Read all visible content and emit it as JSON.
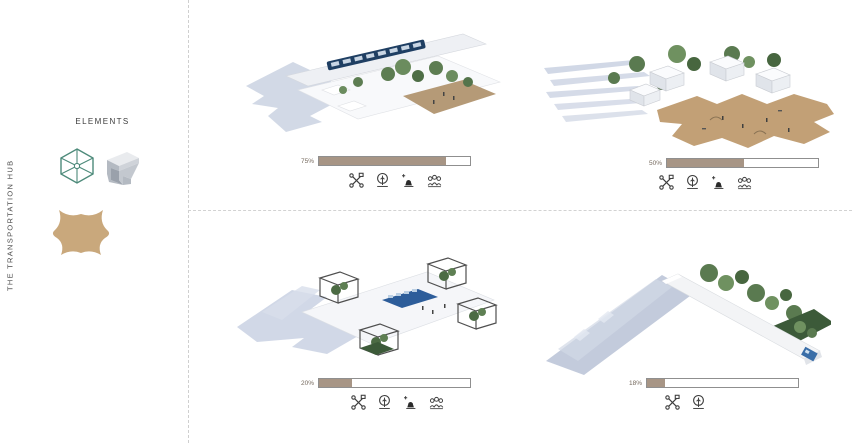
{
  "page": {
    "title": "THE TRANSPORTATION HUB"
  },
  "sidebar": {
    "vertical_title": "THE TRANSPORTATION HUB",
    "elements_label": "ELEMENTS",
    "element_icons": [
      {
        "name": "wireframe-cube-icon",
        "color": "#4d8a7a"
      },
      {
        "name": "folded-plate-icon",
        "color": "#c0c4cc"
      },
      {
        "name": "plaza-blob-icon",
        "color": "#c9a87c"
      }
    ]
  },
  "colors": {
    "bar_fill": "#a79585",
    "bar_border": "#8f8f8f",
    "plaza_tan": "#c2a076",
    "element_teal": "#4d8a7a",
    "shadow_blue": "#c7cfe0",
    "divider_gray": "#cfcfcf"
  },
  "cards": [
    {
      "position": "top-left",
      "render_name": "canopy-hub-render",
      "percent_label": "75%",
      "fill_percent": 84,
      "icons": [
        "drone",
        "tree",
        "bench",
        "people"
      ]
    },
    {
      "position": "top-right",
      "render_name": "village-plaza-render",
      "percent_label": "50%",
      "fill_percent": 51,
      "icons": [
        "drone",
        "tree",
        "bench",
        "people"
      ]
    },
    {
      "position": "bottom-left",
      "render_name": "frame-cubes-render",
      "percent_label": "20%",
      "fill_percent": 22,
      "icons": [
        "drone",
        "tree",
        "bench",
        "people"
      ]
    },
    {
      "position": "bottom-right",
      "render_name": "linear-bar-render",
      "percent_label": "18%",
      "fill_percent": 12,
      "icons": [
        "drone",
        "tree"
      ]
    }
  ]
}
